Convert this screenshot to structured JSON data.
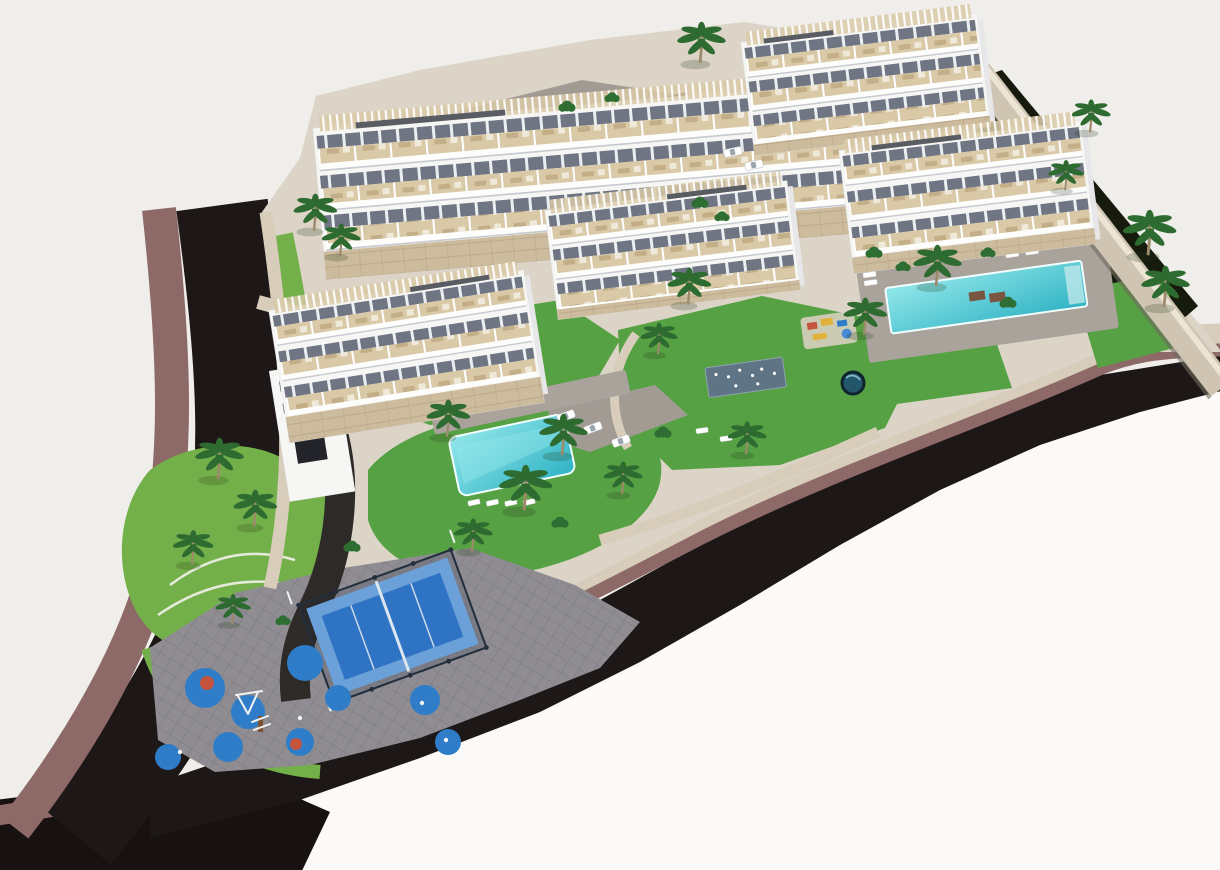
{
  "meta": {
    "title": "Aerial 3D architectural render of a residential apartment development",
    "canvas_width": 1220,
    "canvas_height": 870
  },
  "palette": {
    "background": "#f0eeeb",
    "background_bright": "#fbfaf8",
    "road_asphalt": "#1e1717",
    "road_asphalt_corner": "#171111",
    "sidewalk_mauve": "#8d6a67",
    "stone_path": "#d8cdba",
    "stone_curb_light": "#efe9dd",
    "boundary_wall": "#cfc5b2",
    "boundary_wall_light": "#ece5d5",
    "boundary_wall_edge": "#6e6a5e",
    "shadow_garden": "#161b0e",
    "shadow_garden_streak": "#33511f",
    "ground": "#dbd4c7",
    "drive_gray": "#a19b94",
    "inner_drive": "#2e2a28",
    "plaza_pavers": "#8f8d92",
    "paver_line": "#7b7980",
    "lawn": "#56a143",
    "slope_lawn": "#74b04a",
    "terrace_arc": "#f3f1ea",
    "pool_deck": "#a9a39c",
    "pool_water_deep": "#2fb3c4",
    "pool_water_light": "#92e7ea",
    "pool_rim": "#f2fdfd",
    "pool_steps": "#bfe9ea",
    "splash_pad": "#5f7585",
    "round_pool": "#23566b",
    "padel_court": "#2f74c4",
    "padel_border": "#6ba0d8",
    "padel_cage": "#222e3c",
    "padel_line": "#dbe6ee",
    "playground_pad_blue": "#2f7dc8",
    "playground_accent_red": "#c4543e",
    "playground_yellow": "#e0b23c",
    "building_white": "#f6f6f4",
    "building_side": "#e7e7ea",
    "terrace_beige": "#d9c9a7",
    "window_gray": "#6f7582",
    "railing_white": "#fdfdfc",
    "railing_shadow": "#c6c9ce",
    "roof_gray": "#595d63",
    "base_stone": "#cdbb9e",
    "base_stone_line": "#b5a181",
    "palm_frond": "#2e6b30",
    "palm_trunk": "#9c8a6a",
    "bush": "#2f6e33",
    "car_white": "#ffffff",
    "car_glass": "#9aa4ad",
    "daybed_brown": "#7a5640",
    "equipment_white": "#f2f2f2",
    "equipment_wood": "#7a4f2e"
  },
  "scene": {
    "site_label": "residential-complex-site",
    "buildings": [
      {
        "label": "apartment-block-northwest"
      },
      {
        "label": "apartment-block-north"
      },
      {
        "label": "apartment-block-center"
      },
      {
        "label": "apartment-block-east"
      },
      {
        "label": "apartment-block-southwest"
      }
    ],
    "pools": [
      {
        "label": "north-pool"
      },
      {
        "label": "east-pool"
      },
      {
        "label": "central-pool"
      }
    ],
    "amenities": [
      {
        "label": "padel-court"
      },
      {
        "label": "children-playground"
      },
      {
        "label": "splash-pad"
      },
      {
        "label": "round-plunge-pool"
      },
      {
        "label": "central-garden"
      },
      {
        "label": "landscaped-slope"
      }
    ],
    "roads": [
      {
        "label": "west-perimeter-road"
      },
      {
        "label": "south-perimeter-road"
      }
    ],
    "counts": {
      "palm_trees": 21,
      "parked_cars": 5,
      "sun_loungers": 14,
      "playground_pads": 9
    }
  }
}
